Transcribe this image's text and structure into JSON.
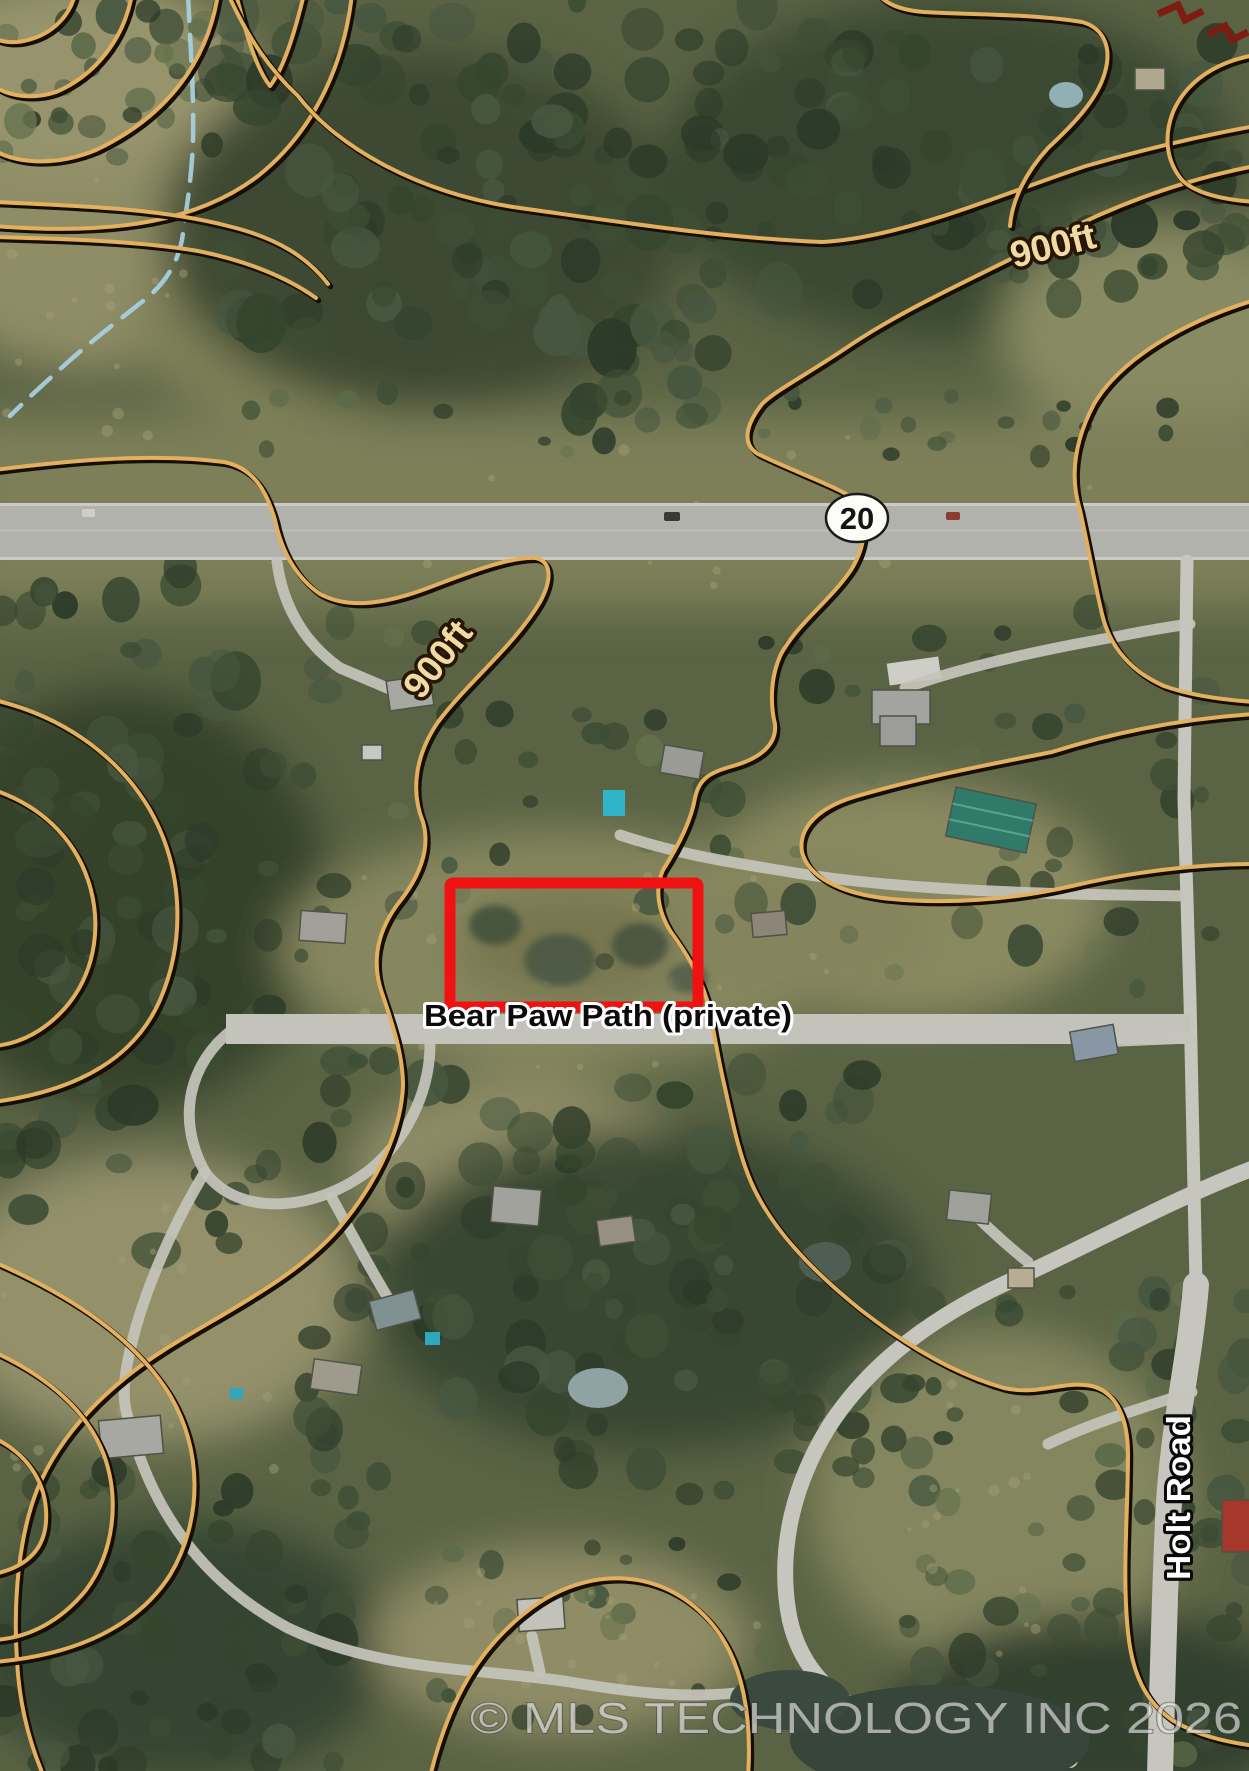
{
  "map": {
    "description": "Aerial parcel map with topographic contour overlay",
    "highway_shield": {
      "route_number": "20"
    },
    "contour_labels": {
      "northeast": "900ft",
      "west": "900ft"
    },
    "road_labels": {
      "private_road": "Bear Paw Path (private)",
      "right_road": "Holt Road"
    },
    "parcel_highlight": {
      "color": "#f01212"
    },
    "watermark": {
      "text": "© MLS TECHNOLOGY INC 2026"
    },
    "colors": {
      "contour_line": "#e3b05f",
      "contour_casing": "#160e04",
      "stream_blue": "#a8d0e2",
      "highway_surface": "#b2b2ac",
      "road_surface": "#c6c5be",
      "contour_label_fill": "#f2dba2",
      "watermark_gray": "#eeeeee",
      "pool_teal": "#30b4c8",
      "green_roof": "#2f7a68",
      "red_roof": "#a8372b"
    }
  }
}
